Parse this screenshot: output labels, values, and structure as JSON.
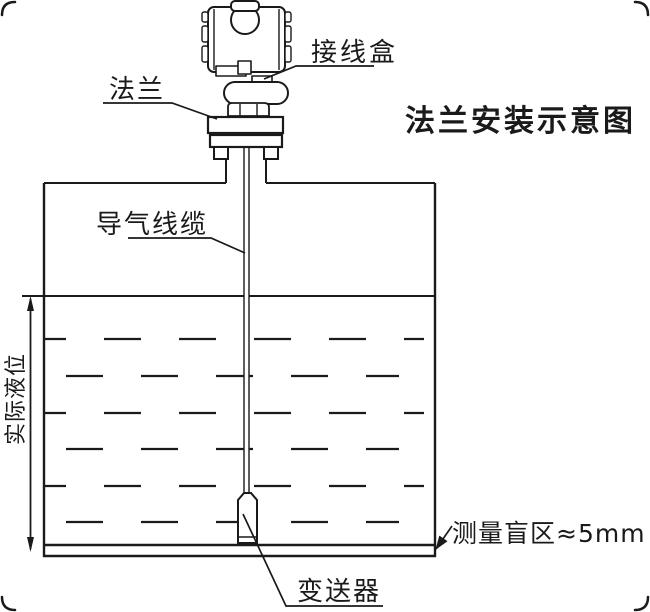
{
  "diagram": {
    "title": "法兰安装示意图",
    "labels": {
      "junction_box": "接线盒",
      "flange": "法兰",
      "air_cable": "导气线缆",
      "actual_level": "实际液位",
      "blind_zone": "测量盲区≈5mm",
      "transmitter": "变送器"
    },
    "colors": {
      "line": "#1a1a1a",
      "background": "#ffffff"
    }
  }
}
